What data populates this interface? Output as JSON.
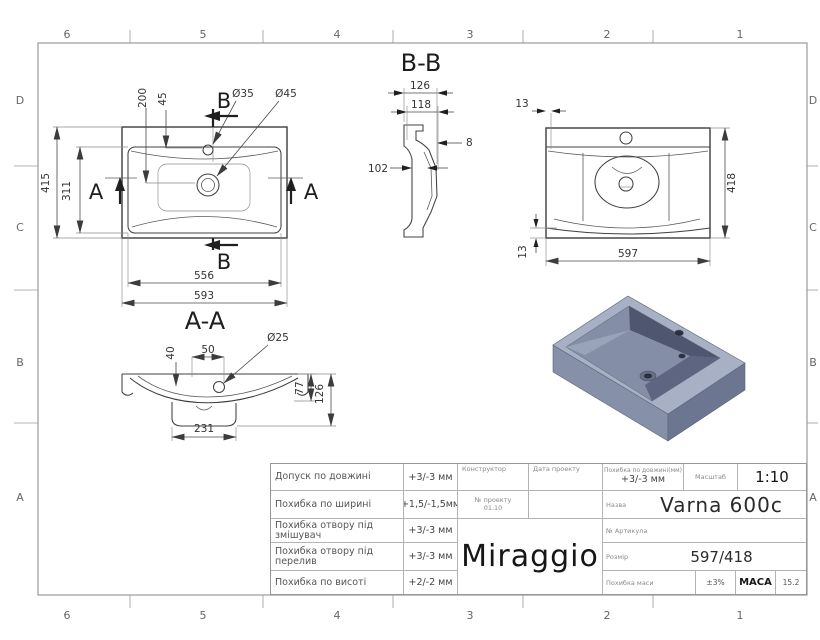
{
  "palette": {
    "line": "#3c3c3c",
    "dim_line": "#4a4a4a",
    "frame": "#9a9a9a",
    "render_top": "#a7b0c4",
    "render_front": "#8690a9",
    "render_side": "#6d7690",
    "render_basin_wall": "#4f5770",
    "render_basin_floor": "#848ea6",
    "render_hole": "#2b3142"
  },
  "border": {
    "cols": [
      "6",
      "5",
      "4",
      "3",
      "2",
      "1"
    ],
    "rows": [
      "D",
      "C",
      "B",
      "A"
    ]
  },
  "plan": {
    "dim_415": "415",
    "dim_311": "311",
    "dim_200": "200",
    "dim_45": "45",
    "dia_35": "Ø35",
    "dia_45": "Ø45",
    "dim_556": "556",
    "dim_593": "593",
    "section_b": "B",
    "section_a": "A"
  },
  "section_aa": {
    "title": "A-A",
    "dim_40": "40",
    "dim_50": "50",
    "dia_25": "Ø25",
    "dim_77": "77",
    "dim_126": "126",
    "dim_231": "231"
  },
  "section_bb": {
    "title": "B-B",
    "dim_126": "126",
    "dim_118": "118",
    "dim_8": "8",
    "dim_102": "102"
  },
  "front": {
    "dim_13_top": "13",
    "dim_13_bottom": "13",
    "dim_597": "597",
    "dim_418": "418"
  },
  "title_block": {
    "tolerances": [
      {
        "label": "Допуск по довжині",
        "value": "+3/-3 мм"
      },
      {
        "label": "Похибка по ширині",
        "value": "+1,5/-1,5мм"
      },
      {
        "label": "Похибка отвору під змішувач",
        "value": "+3/-3 мм"
      },
      {
        "label": "Похибка отвору під перелив",
        "value": "+3/-3 мм"
      },
      {
        "label": "Похибка по висоті",
        "value": "+2/-2 мм"
      }
    ],
    "designer_label": "Конструктор",
    "date_label": "Дата проекту",
    "project_label": "№ проекту",
    "project_value": "01.10",
    "brand": "Miraggio",
    "length_tolerance_label": "Похибка по довжині(мм)",
    "length_tolerance_value": "+3/-3 мм",
    "scale_label": "Масштаб",
    "scale_value": "1:10",
    "name_label": "Назва",
    "name_value": "Varna 600c",
    "article_label": "№ Артикула",
    "article_value": "",
    "size_label": "Розмір",
    "size_value": "597/418",
    "mass_tolerance_label": "Похибка маси",
    "mass_tolerance_value": "±3%",
    "mass_label": "МАСА",
    "mass_value": "15.2"
  }
}
